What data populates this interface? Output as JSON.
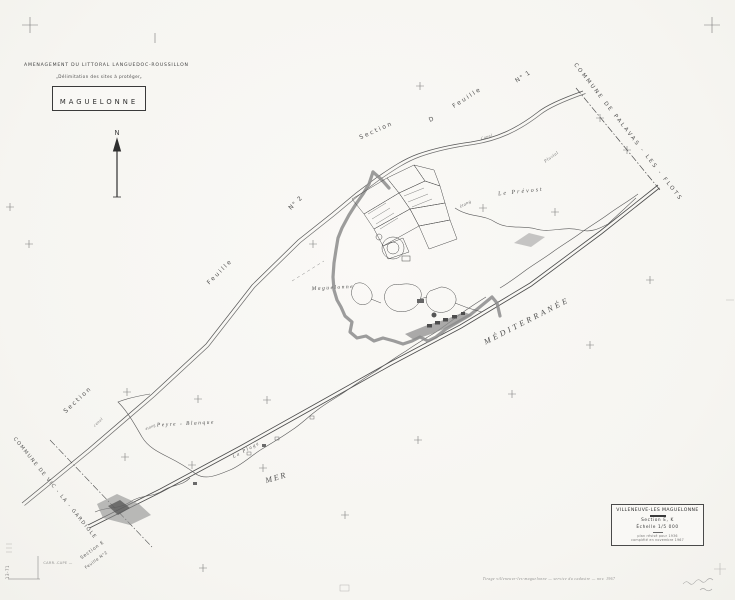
{
  "header": {
    "line1": "AMENAGEMENT DU LITTORAL LANGUEDOC-ROUSSILLON",
    "line2": "„Délimitation des sites à protéger„",
    "sheet_name": "MAGUELONNE"
  },
  "title_block": {
    "commune": "VILLENEUVE-LES MAGUELONNE",
    "section": "Section E, K",
    "scale": "Échelle 1/5 000",
    "note1": "plan révisé pour 1936",
    "note2": "complété en novembre 1967"
  },
  "colors": {
    "paper": "#f8f7f4",
    "ink": "#3c3c3c",
    "line": "#4d4d4d",
    "site_boundary": "#8c8c8c"
  },
  "map_labels": [
    {
      "t": "N",
      "x": 117,
      "y": 135,
      "r": 0,
      "s": 7,
      "ls": 0,
      "i": 0,
      "o": 0.95
    },
    {
      "t": "COMMUNE   DE   PALAVAS - LES - FLOTS",
      "x": 627,
      "y": 133,
      "r": 52,
      "s": 5.5,
      "ls": 2.2,
      "i": 0,
      "o": 0.9
    },
    {
      "t": "Feuille",
      "x": 468,
      "y": 99,
      "r": -33,
      "s": 6,
      "ls": 2,
      "i": 0,
      "o": 0.9
    },
    {
      "t": "N° 1",
      "x": 524,
      "y": 78,
      "r": -33,
      "s": 6,
      "ls": 1,
      "i": 0,
      "o": 0.9
    },
    {
      "t": "Section",
      "x": 377,
      "y": 132,
      "r": -24,
      "s": 6,
      "ls": 2,
      "i": 0,
      "o": 0.9
    },
    {
      "t": "D",
      "x": 432,
      "y": 121,
      "r": -24,
      "s": 6,
      "ls": 0,
      "i": 0,
      "o": 0.9
    },
    {
      "t": "N° 2",
      "x": 297,
      "y": 204,
      "r": -45,
      "s": 6,
      "ls": 1,
      "i": 0,
      "o": 0.9
    },
    {
      "t": "Feuille",
      "x": 221,
      "y": 273,
      "r": -45,
      "s": 6,
      "ls": 2,
      "i": 0,
      "o": 0.9
    },
    {
      "t": "Section",
      "x": 79,
      "y": 401,
      "r": -43,
      "s": 6,
      "ls": 2,
      "i": 0,
      "o": 0.9
    },
    {
      "t": "COMMUNE  DE  VIC - LA - GARDIOLE",
      "x": 54,
      "y": 489,
      "r": 51,
      "s": 5,
      "ls": 1.4,
      "i": 0,
      "o": 0.9
    },
    {
      "t": "Section E",
      "x": 93,
      "y": 551,
      "r": -36,
      "s": 4.5,
      "ls": 0.8,
      "i": 0,
      "o": 0.9
    },
    {
      "t": "Feuille  N°2",
      "x": 97,
      "y": 561,
      "r": -36,
      "s": 4,
      "ls": 0.5,
      "i": 0,
      "o": 0.85
    },
    {
      "t": "CARR..CAPE —",
      "x": 58,
      "y": 564,
      "r": 0,
      "s": 3.5,
      "ls": 0.3,
      "i": 0,
      "o": 0.55
    },
    {
      "t": "Le  Prévost",
      "x": 521,
      "y": 193,
      "r": -6,
      "s": 6,
      "ls": 2,
      "i": 1,
      "o": 0.9
    },
    {
      "t": "étang",
      "x": 466,
      "y": 205,
      "r": -28,
      "s": 4.5,
      "ls": 0.5,
      "i": 1,
      "o": 0.8
    },
    {
      "t": "Pluvial",
      "x": 552,
      "y": 158,
      "r": -35,
      "s": 4.5,
      "ls": 0.5,
      "i": 1,
      "o": 0.75
    },
    {
      "t": "Canal",
      "x": 487,
      "y": 138,
      "r": -18,
      "s": 4,
      "ls": 0.5,
      "i": 1,
      "o": 0.75
    },
    {
      "t": "canal",
      "x": 99,
      "y": 423,
      "r": -42,
      "s": 4,
      "ls": 0.5,
      "i": 1,
      "o": 0.75
    },
    {
      "t": "Maguelonne",
      "x": 333,
      "y": 289,
      "r": -3,
      "s": 5.5,
      "ls": 1.5,
      "i": 1,
      "o": 0.95
    },
    {
      "t": "Peyre  -  Blanque",
      "x": 186,
      "y": 425,
      "r": -3,
      "s": 5.5,
      "ls": 1.5,
      "i": 1,
      "o": 0.95
    },
    {
      "t": "étang",
      "x": 151,
      "y": 428,
      "r": -24,
      "s": 4,
      "ls": 0.4,
      "i": 1,
      "o": 0.8
    },
    {
      "t": "La  Plage",
      "x": 247,
      "y": 451,
      "r": -28,
      "s": 5,
      "ls": 1.5,
      "i": 1,
      "o": 0.9
    },
    {
      "t": "MER",
      "x": 277,
      "y": 480,
      "r": -16,
      "s": 8,
      "ls": 2,
      "i": 1,
      "o": 0.95
    },
    {
      "t": "MÉDITERRANÉE",
      "x": 528,
      "y": 323,
      "r": -27,
      "s": 8,
      "ls": 3,
      "i": 1,
      "o": 0.95
    },
    {
      "t": "13-71",
      "x": 9,
      "y": 572,
      "r": -90,
      "s": 4,
      "ls": 0.5,
      "i": 0,
      "o": 0.65
    },
    {
      "t": "Tirage villeneuve-les-maguelonne — service du cadastre — nov. 1967",
      "x": 549,
      "y": 580,
      "r": 0,
      "s": 3.8,
      "ls": 0.4,
      "i": 1,
      "o": 0.6
    }
  ],
  "grid_crosses": [
    [
      29,
      244
    ],
    [
      313,
      244
    ],
    [
      420,
      86
    ],
    [
      483,
      208
    ],
    [
      555,
      212
    ],
    [
      590,
      345
    ],
    [
      650,
      280
    ],
    [
      127,
      392
    ],
    [
      198,
      399
    ],
    [
      267,
      400
    ],
    [
      125,
      457
    ],
    [
      192,
      465
    ],
    [
      263,
      468
    ],
    [
      418,
      440
    ],
    [
      345,
      515
    ],
    [
      203,
      568
    ],
    [
      600,
      118
    ],
    [
      627,
      150
    ],
    [
      10,
      207
    ],
    [
      512,
      394
    ]
  ]
}
